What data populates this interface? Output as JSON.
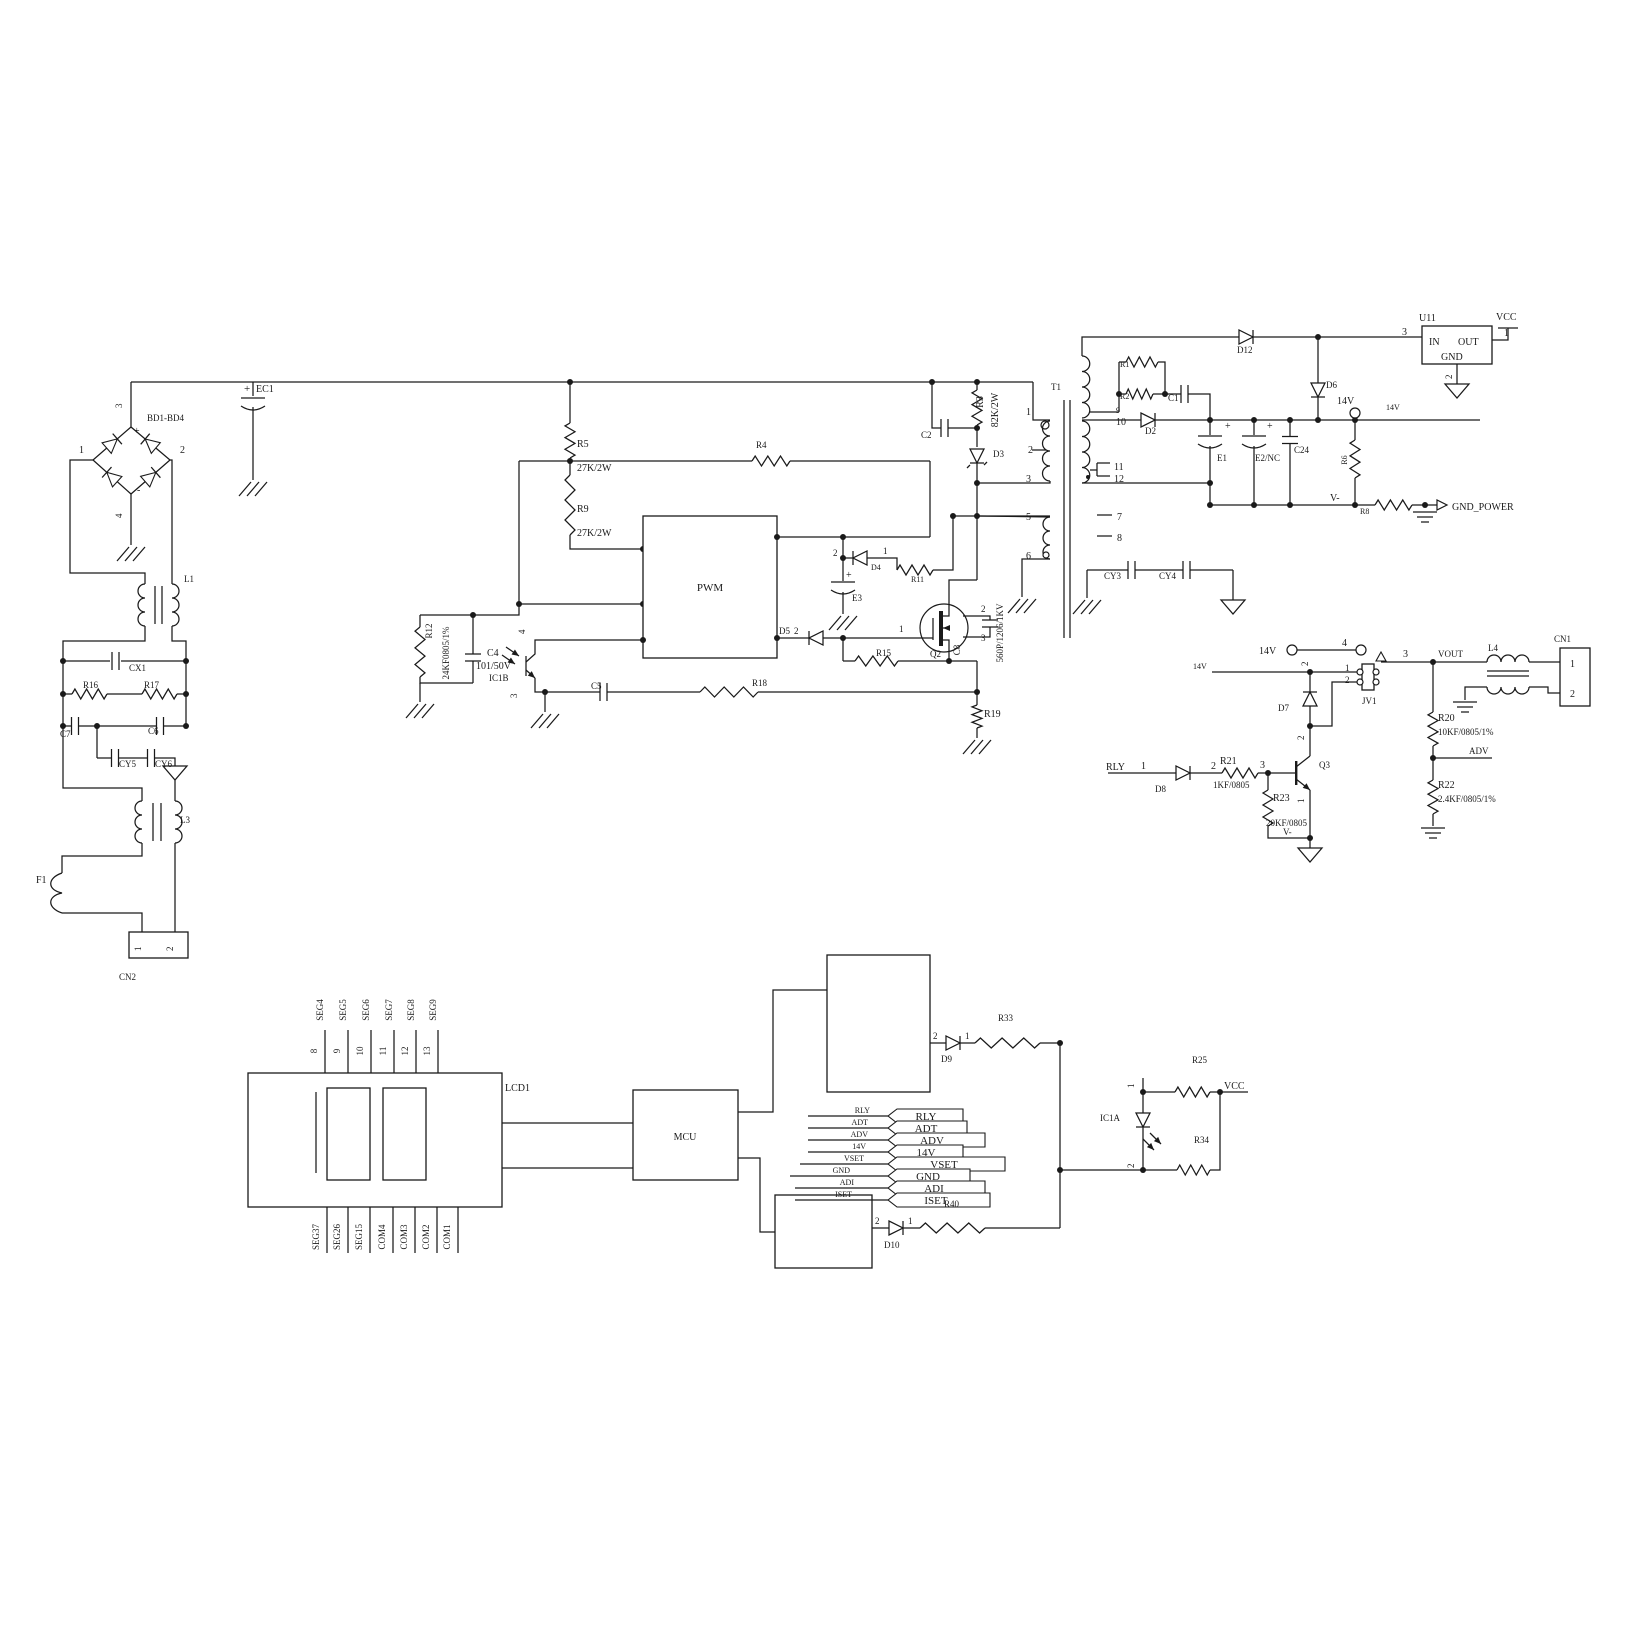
{
  "canvas": {
    "width": 1639,
    "height": 1640,
    "ink": "#1a1a1a",
    "paper": "#ffffff"
  },
  "labels": [
    {
      "n": "bd-pin-3",
      "t": "3",
      "x": 122,
      "y": 408,
      "r": -90,
      "s": 9
    },
    {
      "n": "bd1-bd4",
      "t": "BD1-BD4",
      "x": 147,
      "y": 421,
      "s": 9
    },
    {
      "n": "bd-pin-1",
      "t": "1",
      "x": 79,
      "y": 453,
      "s": 10
    },
    {
      "n": "bd-pin-2",
      "t": "2",
      "x": 180,
      "y": 453,
      "s": 10
    },
    {
      "n": "bd-pin-4",
      "t": "4",
      "x": 122,
      "y": 518,
      "r": -90,
      "s": 9
    },
    {
      "n": "bd-plus",
      "t": "+",
      "x": 134,
      "y": 434,
      "s": 10
    },
    {
      "n": "bd-minus",
      "t": "-",
      "x": 137,
      "y": 493,
      "s": 10
    },
    {
      "n": "ec1-plus",
      "t": "+",
      "x": 244,
      "y": 392,
      "s": 11
    },
    {
      "n": "ec1",
      "t": "EC1",
      "x": 256,
      "y": 392,
      "s": 10
    },
    {
      "n": "l1",
      "t": "L1",
      "x": 184,
      "y": 582,
      "s": 9
    },
    {
      "n": "cx1",
      "t": "CX1",
      "x": 129,
      "y": 671,
      "s": 9
    },
    {
      "n": "r16",
      "t": "R16",
      "x": 83,
      "y": 688,
      "s": 9
    },
    {
      "n": "r17",
      "t": "R17",
      "x": 144,
      "y": 688,
      "s": 9
    },
    {
      "n": "c7",
      "t": "C7",
      "x": 60,
      "y": 737,
      "s": 9
    },
    {
      "n": "c6",
      "t": "C6",
      "x": 148,
      "y": 734,
      "s": 9
    },
    {
      "n": "cy5",
      "t": "CY5",
      "x": 119,
      "y": 767,
      "s": 9
    },
    {
      "n": "cy6",
      "t": "CY6",
      "x": 155,
      "y": 767,
      "s": 9
    },
    {
      "n": "l3",
      "t": "L3",
      "x": 180,
      "y": 823,
      "s": 9
    },
    {
      "n": "f1",
      "t": "F1",
      "x": 36,
      "y": 883,
      "s": 10
    },
    {
      "n": "cn2",
      "t": "CN2",
      "x": 119,
      "y": 980,
      "s": 9
    },
    {
      "n": "cn2-pin-1",
      "t": "1",
      "x": 141,
      "y": 951,
      "r": -90,
      "s": 9
    },
    {
      "n": "cn2-pin-2",
      "t": "2",
      "x": 173,
      "y": 951,
      "r": -90,
      "s": 9
    },
    {
      "n": "r5",
      "t": "R5",
      "x": 577,
      "y": 447,
      "s": 10
    },
    {
      "n": "r5-value",
      "t": "27K/2W",
      "x": 577,
      "y": 471,
      "s": 10
    },
    {
      "n": "r9",
      "t": "R9",
      "x": 577,
      "y": 512,
      "s": 10
    },
    {
      "n": "r9-value",
      "t": "27K/2W",
      "x": 577,
      "y": 536,
      "s": 10
    },
    {
      "n": "r4",
      "t": "R4",
      "x": 756,
      "y": 448,
      "s": 9
    },
    {
      "n": "pwm",
      "t": "PWM",
      "x": 710,
      "y": 591,
      "s": 11,
      "a": "m"
    },
    {
      "n": "r12",
      "t": "R12",
      "x": 432,
      "y": 631,
      "r": -90,
      "s": 9,
      "a": "m"
    },
    {
      "n": "r12-value",
      "t": "24KF0805/1%",
      "x": 449,
      "y": 653,
      "r": -90,
      "s": 9,
      "a": "m"
    },
    {
      "n": "c4",
      "t": "C4",
      "x": 487,
      "y": 656,
      "s": 10
    },
    {
      "n": "c4-value",
      "t": "101/50V",
      "x": 476,
      "y": 669,
      "s": 10
    },
    {
      "n": "ic1b",
      "t": "IC1B",
      "x": 489,
      "y": 681,
      "s": 9
    },
    {
      "n": "ic1b-pin-4",
      "t": "4",
      "x": 525,
      "y": 634,
      "r": -90,
      "s": 9
    },
    {
      "n": "ic1b-pin-3",
      "t": "3",
      "x": 517,
      "y": 698,
      "r": -90,
      "s": 9
    },
    {
      "n": "c5",
      "t": "C5",
      "x": 591,
      "y": 689,
      "s": 9
    },
    {
      "n": "r18",
      "t": "R18",
      "x": 752,
      "y": 686,
      "s": 9
    },
    {
      "n": "d5",
      "t": "D5",
      "x": 779,
      "y": 634,
      "s": 9
    },
    {
      "n": "d5-pin-2",
      "t": "2",
      "x": 794,
      "y": 634,
      "s": 9
    },
    {
      "n": "q2-pin-1",
      "t": "1",
      "x": 899,
      "y": 632,
      "s": 9
    },
    {
      "n": "e3",
      "t": "E3",
      "x": 852,
      "y": 601,
      "s": 9
    },
    {
      "n": "e3-plus",
      "t": "+",
      "x": 846,
      "y": 578,
      "s": 10
    },
    {
      "n": "d4-pin-2",
      "t": "2",
      "x": 833,
      "y": 556,
      "s": 9
    },
    {
      "n": "d4",
      "t": "D4",
      "x": 871,
      "y": 570,
      "s": 8
    },
    {
      "n": "d4-pin-1",
      "t": "1",
      "x": 883,
      "y": 554,
      "s": 9
    },
    {
      "n": "r11",
      "t": "R11",
      "x": 911,
      "y": 582,
      "s": 8
    },
    {
      "n": "r15",
      "t": "R15",
      "x": 876,
      "y": 656,
      "s": 9
    },
    {
      "n": "q2",
      "t": "Q2",
      "x": 930,
      "y": 657,
      "s": 9
    },
    {
      "n": "c8",
      "t": "C8",
      "x": 960,
      "y": 650,
      "r": -90,
      "s": 9,
      "a": "m"
    },
    {
      "n": "c8-value",
      "t": "560P/1206/1KV",
      "x": 1003,
      "y": 633,
      "r": -90,
      "s": 9,
      "a": "m"
    },
    {
      "n": "q2-pin-2",
      "t": "2",
      "x": 981,
      "y": 612,
      "s": 9
    },
    {
      "n": "q2-pin-3",
      "t": "3",
      "x": 981,
      "y": 641,
      "s": 9
    },
    {
      "n": "r19",
      "t": "R19",
      "x": 984,
      "y": 717,
      "s": 10
    },
    {
      "n": "c2",
      "t": "C2",
      "x": 921,
      "y": 438,
      "s": 9
    },
    {
      "n": "r3",
      "t": "R3",
      "x": 983,
      "y": 402,
      "r": -90,
      "s": 10,
      "a": "m"
    },
    {
      "n": "r3-value",
      "t": "82K/2W",
      "x": 998,
      "y": 410,
      "r": -90,
      "s": 10,
      "a": "m"
    },
    {
      "n": "d3",
      "t": "D3",
      "x": 993,
      "y": 457,
      "s": 9
    },
    {
      "n": "t1",
      "t": "T1",
      "x": 1051,
      "y": 390,
      "s": 9
    },
    {
      "n": "t1-pin-1",
      "t": "1",
      "x": 1026,
      "y": 415,
      "s": 10
    },
    {
      "n": "t1-pin-2",
      "t": "2",
      "x": 1028,
      "y": 453,
      "s": 10
    },
    {
      "n": "t1-pin-3",
      "t": "3",
      "x": 1026,
      "y": 482,
      "s": 10
    },
    {
      "n": "t1-pin-5",
      "t": "5",
      "x": 1026,
      "y": 520,
      "s": 10
    },
    {
      "n": "t1-pin-6",
      "t": "6",
      "x": 1026,
      "y": 559,
      "s": 10
    },
    {
      "n": "t1-pin-9",
      "t": "9",
      "x": 1116,
      "y": 413,
      "s": 8
    },
    {
      "n": "t1-pin-10",
      "t": "10",
      "x": 1116,
      "y": 425,
      "s": 10
    },
    {
      "n": "t1-pin-11",
      "t": "11",
      "x": 1114,
      "y": 470,
      "s": 10
    },
    {
      "n": "t1-pin-12",
      "t": "12",
      "x": 1114,
      "y": 482,
      "s": 10
    },
    {
      "n": "t1-pin-7",
      "t": "7",
      "x": 1117,
      "y": 520,
      "s": 10
    },
    {
      "n": "t1-pin-8",
      "t": "8",
      "x": 1117,
      "y": 541,
      "s": 10
    },
    {
      "n": "r1",
      "t": "R1",
      "x": 1120,
      "y": 367,
      "s": 8
    },
    {
      "n": "r2",
      "t": "R2",
      "x": 1120,
      "y": 399,
      "s": 8
    },
    {
      "n": "c1",
      "t": "C1",
      "x": 1168,
      "y": 401,
      "s": 9
    },
    {
      "n": "d2",
      "t": "D2",
      "x": 1145,
      "y": 434,
      "s": 9
    },
    {
      "n": "d12",
      "t": "D12",
      "x": 1237,
      "y": 353,
      "s": 9
    },
    {
      "n": "e1",
      "t": "E1",
      "x": 1217,
      "y": 461,
      "s": 9
    },
    {
      "n": "e1-plus",
      "t": "+",
      "x": 1225,
      "y": 429,
      "s": 10
    },
    {
      "n": "e2",
      "t": "E2/NC",
      "x": 1255,
      "y": 461,
      "s": 9
    },
    {
      "n": "e2-plus",
      "t": "+",
      "x": 1267,
      "y": 429,
      "s": 10
    },
    {
      "n": "c24",
      "t": "C24",
      "x": 1294,
      "y": 453,
      "s": 9
    },
    {
      "n": "d6",
      "t": "D6",
      "x": 1326,
      "y": 388,
      "s": 9
    },
    {
      "n": "u11",
      "t": "U11",
      "x": 1419,
      "y": 321,
      "s": 10
    },
    {
      "n": "u11-in",
      "t": "IN",
      "x": 1429,
      "y": 345,
      "s": 10
    },
    {
      "n": "u11-out",
      "t": "OUT",
      "x": 1458,
      "y": 345,
      "s": 10
    },
    {
      "n": "u11-gnd",
      "t": "GND",
      "x": 1441,
      "y": 360,
      "s": 10
    },
    {
      "n": "u11-pin-3",
      "t": "3",
      "x": 1402,
      "y": 335,
      "s": 10
    },
    {
      "n": "u11-pin-1",
      "t": "1",
      "x": 1504,
      "y": 336,
      "s": 10
    },
    {
      "n": "u11-pin-2",
      "t": "2",
      "x": 1452,
      "y": 379,
      "r": -90,
      "s": 9
    },
    {
      "n": "vcc-u11",
      "t": "VCC",
      "x": 1496,
      "y": 320,
      "s": 10
    },
    {
      "n": "14v-node",
      "t": "14V",
      "x": 1337,
      "y": 404,
      "s": 10
    },
    {
      "n": "14v-wire",
      "t": "14V",
      "x": 1386,
      "y": 410,
      "s": 8
    },
    {
      "n": "r6",
      "t": "R6",
      "x": 1347,
      "y": 460,
      "r": -90,
      "s": 8,
      "a": "m"
    },
    {
      "n": "v-minus-1",
      "t": "V-",
      "x": 1330,
      "y": 501,
      "s": 10
    },
    {
      "n": "r8",
      "t": "R8",
      "x": 1360,
      "y": 514,
      "s": 8
    },
    {
      "n": "gnd-power",
      "t": "GND_POWER",
      "x": 1452,
      "y": 510,
      "s": 10
    },
    {
      "n": "cy3",
      "t": "CY3",
      "x": 1104,
      "y": 579,
      "s": 9
    },
    {
      "n": "cy4",
      "t": "CY4",
      "x": 1159,
      "y": 579,
      "s": 9
    },
    {
      "n": "14v-sw",
      "t": "14V",
      "x": 1259,
      "y": 654,
      "s": 10
    },
    {
      "n": "sw-pin-4",
      "t": "4",
      "x": 1342,
      "y": 646,
      "s": 10
    },
    {
      "n": "sw-pin-3",
      "t": "3",
      "x": 1403,
      "y": 657,
      "s": 10
    },
    {
      "n": "vout",
      "t": "VOUT",
      "x": 1438,
      "y": 657,
      "s": 9
    },
    {
      "n": "l4",
      "t": "L4",
      "x": 1488,
      "y": 651,
      "s": 9
    },
    {
      "n": "cn1",
      "t": "CN1",
      "x": 1554,
      "y": 642,
      "s": 9
    },
    {
      "n": "cn1-pin-1",
      "t": "1",
      "x": 1570,
      "y": 667,
      "s": 10
    },
    {
      "n": "cn1-pin-2",
      "t": "2",
      "x": 1570,
      "y": 697,
      "s": 10
    },
    {
      "n": "14v-wire-2",
      "t": "14V",
      "x": 1193,
      "y": 669,
      "s": 8
    },
    {
      "n": "jv1-coil-pin-2",
      "t": "2",
      "x": 1308,
      "y": 666,
      "r": -90,
      "s": 9
    },
    {
      "n": "jv1-pin-1",
      "t": "1",
      "x": 1345,
      "y": 671,
      "s": 9
    },
    {
      "n": "jv1-pin-2",
      "t": "2",
      "x": 1345,
      "y": 683,
      "s": 9
    },
    {
      "n": "jv1",
      "t": "JV1",
      "x": 1362,
      "y": 704,
      "s": 9
    },
    {
      "n": "d7",
      "t": "D7",
      "x": 1278,
      "y": 711,
      "s": 9
    },
    {
      "n": "q3-pin-2",
      "t": "2",
      "x": 1304,
      "y": 740,
      "r": -90,
      "s": 9
    },
    {
      "n": "q3-pin-1",
      "t": "1",
      "x": 1304,
      "y": 803,
      "r": -90,
      "s": 9
    },
    {
      "n": "q3",
      "t": "Q3",
      "x": 1319,
      "y": 768,
      "s": 9
    },
    {
      "n": "rly",
      "t": "RLY",
      "x": 1106,
      "y": 770,
      "s": 10
    },
    {
      "n": "d8-pin-1",
      "t": "1",
      "x": 1141,
      "y": 769,
      "s": 10
    },
    {
      "n": "d8",
      "t": "D8",
      "x": 1155,
      "y": 792,
      "s": 9
    },
    {
      "n": "d8-pin-2",
      "t": "2",
      "x": 1211,
      "y": 769,
      "s": 10
    },
    {
      "n": "r21",
      "t": "R21",
      "x": 1220,
      "y": 764,
      "s": 10
    },
    {
      "n": "r21-value",
      "t": "1KF/0805",
      "x": 1213,
      "y": 788,
      "s": 9
    },
    {
      "n": "r21-pin-3",
      "t": "3",
      "x": 1260,
      "y": 768,
      "s": 10
    },
    {
      "n": "r23",
      "t": "R23",
      "x": 1273,
      "y": 801,
      "s": 10
    },
    {
      "n": "r23-value",
      "t": "20KF/0805",
      "x": 1266,
      "y": 826,
      "s": 9
    },
    {
      "n": "v-minus-2",
      "t": "V-",
      "x": 1283,
      "y": 835,
      "s": 9
    },
    {
      "n": "r20",
      "t": "R20",
      "x": 1438,
      "y": 721,
      "s": 10
    },
    {
      "n": "r20-value",
      "t": "10KF/0805/1%",
      "x": 1438,
      "y": 735,
      "s": 9
    },
    {
      "n": "adv",
      "t": "ADV",
      "x": 1469,
      "y": 754,
      "s": 9
    },
    {
      "n": "r22",
      "t": "R22",
      "x": 1438,
      "y": 788,
      "s": 10
    },
    {
      "n": "r22-value",
      "t": "2.4KF/0805/1%",
      "x": 1438,
      "y": 802,
      "s": 9
    },
    {
      "n": "lcd1",
      "t": "LCD1",
      "x": 505,
      "y": 1091,
      "s": 10
    },
    {
      "n": "seg4",
      "t": "SEG4",
      "x": 323,
      "y": 1010,
      "r": -90,
      "s": 9,
      "a": "m"
    },
    {
      "n": "seg5",
      "t": "SEG5",
      "x": 346,
      "y": 1010,
      "r": -90,
      "s": 9,
      "a": "m"
    },
    {
      "n": "seg6",
      "t": "SEG6",
      "x": 369,
      "y": 1010,
      "r": -90,
      "s": 9,
      "a": "m"
    },
    {
      "n": "seg7",
      "t": "SEG7",
      "x": 392,
      "y": 1010,
      "r": -90,
      "s": 9,
      "a": "m"
    },
    {
      "n": "seg8",
      "t": "SEG8",
      "x": 414,
      "y": 1010,
      "r": -90,
      "s": 9,
      "a": "m"
    },
    {
      "n": "seg9",
      "t": "SEG9",
      "x": 436,
      "y": 1010,
      "r": -90,
      "s": 9,
      "a": "m"
    },
    {
      "n": "lcd-pin-8",
      "t": "8",
      "x": 317,
      "y": 1051,
      "r": -90,
      "s": 9,
      "a": "m"
    },
    {
      "n": "lcd-pin-9",
      "t": "9",
      "x": 340,
      "y": 1051,
      "r": -90,
      "s": 9,
      "a": "m"
    },
    {
      "n": "lcd-pin-10",
      "t": "10",
      "x": 363,
      "y": 1051,
      "r": -90,
      "s": 9,
      "a": "m"
    },
    {
      "n": "lcd-pin-11",
      "t": "11",
      "x": 386,
      "y": 1051,
      "r": -90,
      "s": 9,
      "a": "m"
    },
    {
      "n": "lcd-pin-12",
      "t": "12",
      "x": 408,
      "y": 1051,
      "r": -90,
      "s": 9,
      "a": "m"
    },
    {
      "n": "lcd-pin-13",
      "t": "13",
      "x": 430,
      "y": 1051,
      "r": -90,
      "s": 9,
      "a": "m"
    },
    {
      "n": "seg37",
      "t": "SEG37",
      "x": 319,
      "y": 1237,
      "r": -90,
      "s": 9,
      "a": "m"
    },
    {
      "n": "seg26",
      "t": "SEG26",
      "x": 340,
      "y": 1237,
      "r": -90,
      "s": 9,
      "a": "m"
    },
    {
      "n": "seg15",
      "t": "SEG15",
      "x": 362,
      "y": 1237,
      "r": -90,
      "s": 9,
      "a": "m"
    },
    {
      "n": "com4",
      "t": "COM4",
      "x": 385,
      "y": 1237,
      "r": -90,
      "s": 9,
      "a": "m"
    },
    {
      "n": "com3",
      "t": "COM3",
      "x": 407,
      "y": 1237,
      "r": -90,
      "s": 9,
      "a": "m"
    },
    {
      "n": "com2",
      "t": "COM2",
      "x": 429,
      "y": 1237,
      "r": -90,
      "s": 9,
      "a": "m"
    },
    {
      "n": "com1",
      "t": "COM1",
      "x": 450,
      "y": 1237,
      "r": -90,
      "s": 9,
      "a": "m"
    },
    {
      "n": "mcu",
      "t": "MCU",
      "x": 685,
      "y": 1140,
      "s": 10,
      "a": "m"
    },
    {
      "n": "rly-wire",
      "t": "RLY",
      "x": 870,
      "y": 1113,
      "s": 8,
      "a": "e"
    },
    {
      "n": "adt-wire",
      "t": "ADT",
      "x": 868,
      "y": 1125,
      "s": 8,
      "a": "e"
    },
    {
      "n": "adv-wire",
      "t": "ADV",
      "x": 868,
      "y": 1137,
      "s": 8,
      "a": "e"
    },
    {
      "n": "14v-flag-wire",
      "t": "14V",
      "x": 866,
      "y": 1149,
      "s": 8,
      "a": "e"
    },
    {
      "n": "vset-wire",
      "t": "VSET",
      "x": 864,
      "y": 1161,
      "s": 8,
      "a": "e"
    },
    {
      "n": "gnd-wire",
      "t": "GND",
      "x": 850,
      "y": 1173,
      "s": 8,
      "a": "e"
    },
    {
      "n": "adi-wire",
      "t": "ADI",
      "x": 854,
      "y": 1185,
      "s": 8,
      "a": "e"
    },
    {
      "n": "iset-wire",
      "t": "ISET",
      "x": 852,
      "y": 1197,
      "s": 8,
      "a": "e"
    },
    {
      "n": "flag-rly",
      "t": "RLY",
      "x": 926,
      "y": 1120,
      "s": 11,
      "a": "m"
    },
    {
      "n": "flag-adt",
      "t": "ADT",
      "x": 926,
      "y": 1132,
      "s": 11,
      "a": "m"
    },
    {
      "n": "flag-adv",
      "t": "ADV",
      "x": 932,
      "y": 1144,
      "s": 11,
      "a": "m"
    },
    {
      "n": "flag-14v",
      "t": "14V",
      "x": 926,
      "y": 1156,
      "s": 11,
      "a": "m"
    },
    {
      "n": "flag-vset",
      "t": "VSET",
      "x": 944,
      "y": 1168,
      "s": 11,
      "a": "m"
    },
    {
      "n": "flag-gnd",
      "t": "GND",
      "x": 928,
      "y": 1180,
      "s": 11,
      "a": "m"
    },
    {
      "n": "flag-adi",
      "t": "ADI",
      "x": 934,
      "y": 1192,
      "s": 11,
      "a": "m"
    },
    {
      "n": "flag-iset",
      "t": "ISET",
      "x": 936,
      "y": 1204,
      "s": 11,
      "a": "m"
    },
    {
      "n": "d9-pin-2",
      "t": "2",
      "x": 933,
      "y": 1039,
      "s": 9
    },
    {
      "n": "d9",
      "t": "D9",
      "x": 941,
      "y": 1062,
      "s": 9
    },
    {
      "n": "d9-pin-1",
      "t": "1",
      "x": 965,
      "y": 1039,
      "s": 9
    },
    {
      "n": "r33",
      "t": "R33",
      "x": 998,
      "y": 1021,
      "s": 9
    },
    {
      "n": "d10-pin-2",
      "t": "2",
      "x": 875,
      "y": 1224,
      "s": 9
    },
    {
      "n": "d10",
      "t": "D10",
      "x": 884,
      "y": 1248,
      "s": 9
    },
    {
      "n": "d10-pin-1",
      "t": "1",
      "x": 908,
      "y": 1224,
      "s": 9
    },
    {
      "n": "r40",
      "t": "R40",
      "x": 944,
      "y": 1207,
      "s": 9
    },
    {
      "n": "ic1a",
      "t": "IC1A",
      "x": 1100,
      "y": 1121,
      "s": 9
    },
    {
      "n": "ic1a-pin-1",
      "t": "1",
      "x": 1134,
      "y": 1088,
      "r": -90,
      "s": 9
    },
    {
      "n": "ic1a-pin-2",
      "t": "2",
      "x": 1134,
      "y": 1168,
      "r": -90,
      "s": 9
    },
    {
      "n": "r25",
      "t": "R25",
      "x": 1192,
      "y": 1063,
      "s": 9
    },
    {
      "n": "r34",
      "t": "R34",
      "x": 1194,
      "y": 1143,
      "s": 9
    },
    {
      "n": "vcc-led",
      "t": "VCC",
      "x": 1224,
      "y": 1089,
      "s": 10
    }
  ]
}
